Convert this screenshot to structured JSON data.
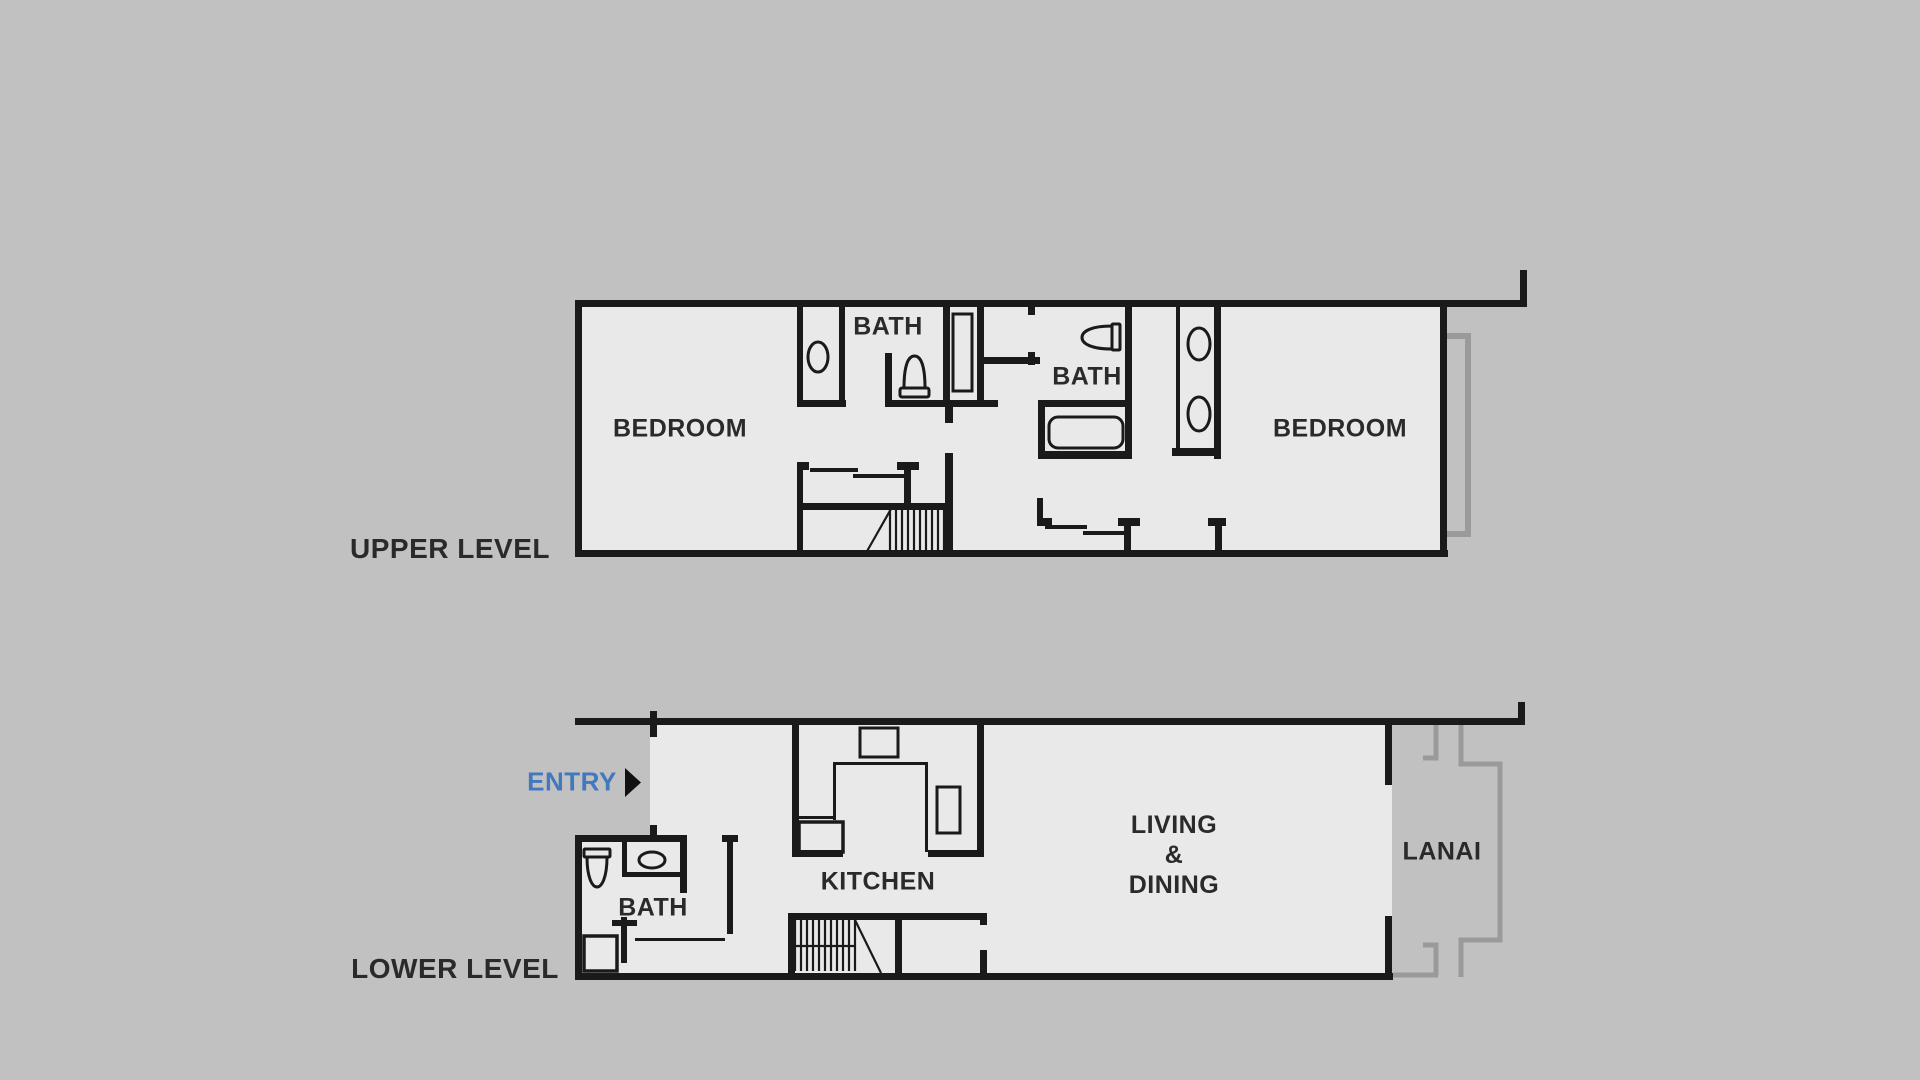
{
  "palette": {
    "background": "#c1c1c1",
    "floor": "#e9e9e9",
    "walls": "#1a1a1a",
    "accent_blue": "#4178be",
    "lanai_outline": "#9a9a9a",
    "text": "#2a2a2a"
  },
  "upper": {
    "title": "UPPER LEVEL",
    "bedroom_left": "BEDROOM",
    "bath_left": "BATH",
    "bath_right": "BATH",
    "bedroom_right": "BEDROOM"
  },
  "lower": {
    "title": "LOWER LEVEL",
    "entry": "ENTRY",
    "bath": "BATH",
    "kitchen": "KITCHEN",
    "living_line1": "LIVING",
    "living_line2": "&",
    "living_line3": "DINING",
    "lanai": "LANAI"
  },
  "icons": {
    "entry_arrow": "right-pointing-triangle",
    "fixtures": [
      "sink",
      "toilet",
      "shower",
      "bathtub",
      "double-vanity",
      "range",
      "kitchen-sink",
      "refrigerator",
      "stairs"
    ]
  }
}
